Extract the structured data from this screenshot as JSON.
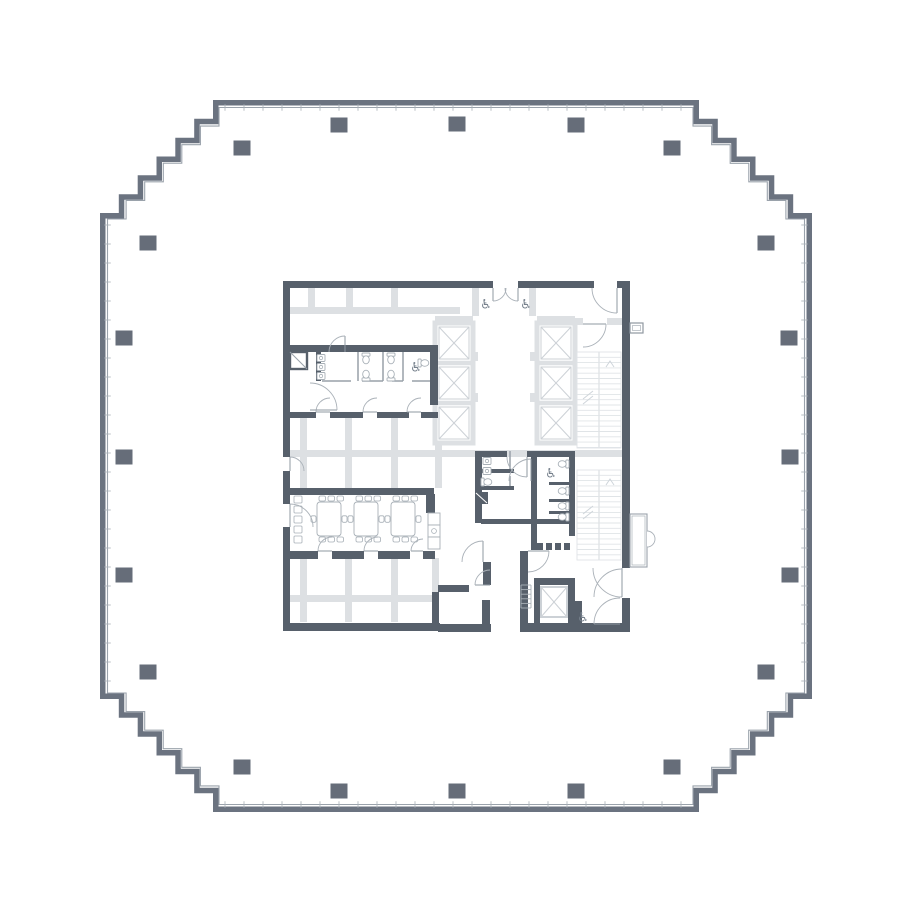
{
  "canvas": {
    "width": 914,
    "height": 914,
    "background": "#ffffff"
  },
  "palette": {
    "outer_wall": "#6b7380",
    "inner_line": "#9aa2ab",
    "mullion_tick": "#a9b0b7",
    "column": "#666d79",
    "wall": "#57606b",
    "light_wall": "#dde0e3",
    "shaft_line": "#ccd1d6",
    "stair_line": "#e0e4e7",
    "stair_mark": "#cfd5da",
    "fixture_line": "#a8b0b7",
    "door_line": "#aab1b8",
    "leaf_line": "#8f98a1",
    "icon": "#76808c",
    "thin_wall": "#98a1a9"
  },
  "outline": {
    "outer": {
      "min": 100,
      "max": 812,
      "flat": 213
    },
    "inner": {
      "min": 107.5,
      "max": 804.5,
      "flat": 219
    },
    "steps": 6,
    "tick_spacing": 19
  },
  "columns": {
    "w": 17,
    "h": 15,
    "centers": [
      [
        339,
        125
      ],
      [
        457,
        124
      ],
      [
        576,
        125
      ],
      [
        242,
        148
      ],
      [
        672,
        148
      ],
      [
        148,
        243
      ],
      [
        766,
        243
      ],
      [
        124,
        338
      ],
      [
        789,
        338
      ],
      [
        124,
        457
      ],
      [
        790,
        457
      ],
      [
        124,
        575
      ],
      [
        790,
        575
      ],
      [
        148,
        672
      ],
      [
        766,
        672
      ],
      [
        242,
        767
      ],
      [
        672,
        767
      ],
      [
        339,
        791
      ],
      [
        457,
        791
      ],
      [
        576,
        791
      ]
    ]
  },
  "core": {
    "light_bars": [
      [
        288,
        307,
        172,
        7
      ],
      [
        308,
        288,
        7,
        19
      ],
      [
        346,
        288,
        7,
        19
      ],
      [
        391,
        288,
        7,
        19
      ],
      [
        300,
        418,
        7,
        70
      ],
      [
        345,
        418,
        7,
        70
      ],
      [
        391,
        418,
        7,
        70
      ],
      [
        435,
        418,
        7,
        70
      ],
      [
        288,
        450,
        340,
        7
      ],
      [
        300,
        558,
        7,
        64
      ],
      [
        345,
        558,
        7,
        64
      ],
      [
        391,
        558,
        7,
        64
      ],
      [
        432,
        558,
        7,
        64
      ],
      [
        288,
        595,
        150,
        7
      ],
      [
        472,
        288,
        7,
        28
      ],
      [
        529,
        288,
        7,
        28
      ],
      [
        435,
        316,
        38,
        7
      ],
      [
        537,
        316,
        38,
        7
      ],
      [
        473,
        352,
        5,
        9
      ],
      [
        473,
        393,
        5,
        9
      ],
      [
        530,
        352,
        5,
        9
      ],
      [
        530,
        393,
        5,
        9
      ],
      [
        575,
        318,
        8,
        7
      ],
      [
        607,
        318,
        16,
        7
      ]
    ],
    "elevator_banks": [
      {
        "x": 435,
        "y": 323,
        "w": 38,
        "h": 120,
        "cells": 3
      },
      {
        "x": 537,
        "y": 323,
        "w": 38,
        "h": 120,
        "cells": 3
      }
    ],
    "service_shaft": {
      "x": 541,
      "y": 587,
      "w": 26,
      "h": 30
    },
    "stairs": [
      {
        "x": 577,
        "y": 352,
        "w": 44,
        "h": 96
      },
      {
        "x": 577,
        "y": 470,
        "w": 44,
        "h": 90
      }
    ],
    "walls": [
      [
        283,
        281,
        210,
        7
      ],
      [
        518,
        281,
        76,
        7
      ],
      [
        617,
        281,
        13,
        7
      ],
      [
        283,
        281,
        7,
        131
      ],
      [
        283,
        418,
        7,
        39
      ],
      [
        283,
        471,
        7,
        33
      ],
      [
        283,
        527,
        7,
        103
      ],
      [
        283,
        412,
        33,
        6
      ],
      [
        330,
        412,
        33,
        6
      ],
      [
        377,
        412,
        32,
        6
      ],
      [
        421,
        412,
        17,
        6
      ],
      [
        283,
        345,
        155,
        7
      ],
      [
        316,
        352,
        5,
        29
      ],
      [
        430,
        352,
        8,
        53
      ],
      [
        288,
        488,
        146,
        7
      ],
      [
        288,
        551,
        30,
        8
      ],
      [
        332,
        551,
        32,
        8
      ],
      [
        378,
        551,
        32,
        8
      ],
      [
        423,
        551,
        12,
        8
      ],
      [
        426,
        494,
        9,
        19
      ],
      [
        432,
        592,
        7,
        38
      ],
      [
        438,
        585,
        31,
        7
      ],
      [
        482,
        600,
        8,
        32
      ],
      [
        483,
        562,
        8,
        23
      ],
      [
        283,
        623,
        157,
        8
      ],
      [
        438,
        624,
        53,
        8
      ],
      [
        520,
        623,
        110,
        9
      ],
      [
        475,
        451,
        32,
        6
      ],
      [
        527,
        451,
        48,
        6
      ],
      [
        475,
        451,
        7,
        41
      ],
      [
        475,
        504,
        7,
        19
      ],
      [
        481,
        519,
        50,
        5
      ],
      [
        531,
        451,
        6,
        74
      ],
      [
        569,
        451,
        6,
        85
      ],
      [
        482,
        469,
        32,
        4
      ],
      [
        482,
        486,
        32,
        4
      ],
      [
        549,
        482,
        20,
        3
      ],
      [
        549,
        499,
        20,
        3
      ],
      [
        549,
        511,
        20,
        3
      ],
      [
        531,
        519,
        44,
        5
      ],
      [
        531,
        519,
        6,
        31
      ],
      [
        520,
        551,
        8,
        72
      ],
      [
        534,
        578,
        41,
        7
      ],
      [
        534,
        585,
        6,
        40
      ],
      [
        568,
        585,
        7,
        40
      ],
      [
        622,
        281,
        8,
        287
      ],
      [
        622,
        598,
        8,
        34
      ],
      [
        575,
        601,
        7,
        31
      ]
    ],
    "thin_walls": [
      [
        358,
        352,
        358,
        381
      ],
      [
        383,
        352,
        383,
        381
      ],
      [
        403,
        352,
        403,
        381
      ],
      [
        322,
        381,
        351,
        381
      ],
      [
        362,
        381,
        383,
        381
      ],
      [
        392,
        381,
        403,
        381
      ],
      [
        412,
        381,
        430,
        381
      ],
      [
        510,
        451,
        510,
        469
      ],
      [
        510,
        476,
        510,
        490
      ]
    ],
    "louvers": {
      "y": 543,
      "x0": 537,
      "n": 4,
      "w": 6,
      "gap": 3,
      "h": 7
    },
    "diag_boxes": [
      {
        "x": 290,
        "y": 352,
        "w": 17,
        "h": 17,
        "filled": false
      },
      {
        "x": 475,
        "y": 492,
        "w": 13,
        "h": 12,
        "filled": true
      }
    ],
    "doors": [
      [
        493,
        288,
        13,
        90,
        0
      ],
      [
        518,
        288,
        13,
        90,
        180
      ],
      [
        617,
        288,
        25,
        90,
        180
      ],
      [
        583,
        324,
        23,
        0,
        90
      ],
      [
        330,
        412,
        14,
        180,
        270
      ],
      [
        377,
        412,
        14,
        180,
        270
      ],
      [
        421,
        412,
        14,
        180,
        270
      ],
      [
        310,
        410,
        27,
        0,
        270
      ],
      [
        290,
        471,
        14,
        270,
        0
      ],
      [
        290,
        527,
        23,
        270,
        0
      ],
      [
        332,
        551,
        14,
        180,
        270
      ],
      [
        378,
        551,
        14,
        180,
        270
      ],
      [
        423,
        551,
        12,
        180,
        270
      ],
      [
        527,
        457,
        20,
        90,
        180
      ],
      [
        531,
        481,
        22,
        270,
        180
      ],
      [
        483,
        562,
        21,
        270,
        180
      ],
      [
        490,
        585,
        15,
        180,
        270
      ],
      [
        622,
        568,
        29,
        90,
        180
      ],
      [
        622,
        597,
        28,
        270,
        180
      ],
      [
        620,
        624,
        26,
        180,
        270
      ],
      [
        528,
        551,
        21,
        0,
        90
      ],
      [
        345,
        352,
        16,
        270,
        180
      ]
    ],
    "vestibule": {
      "x": 630,
      "y": 514,
      "w": 17,
      "h": 53,
      "door_y1": 531,
      "door_y2": 547,
      "bulge": 8
    },
    "cabinet": {
      "x": 630,
      "y": 323,
      "w": 13,
      "h": 10
    },
    "ladder": {
      "x": 521,
      "y": 585,
      "w": 10,
      "dy": 4.6,
      "n": 5
    },
    "toilets": [
      [
        366,
        360,
        0
      ],
      [
        391,
        360,
        0
      ],
      [
        425,
        363,
        270
      ],
      [
        366,
        374,
        180
      ],
      [
        391,
        374,
        180
      ],
      [
        488,
        482,
        270
      ],
      [
        562,
        464,
        90
      ],
      [
        562,
        491,
        90
      ],
      [
        562,
        506,
        90
      ],
      [
        562,
        517,
        90
      ]
    ],
    "sinks": [
      [
        321,
        358
      ],
      [
        321,
        367
      ],
      [
        321,
        376
      ],
      [
        487,
        461
      ],
      [
        487,
        471
      ]
    ],
    "tables": [
      [
        317,
        502,
        24,
        34
      ],
      [
        354,
        502,
        24,
        34
      ],
      [
        391,
        502,
        24,
        34
      ]
    ],
    "stools": [
      [
        294,
        496
      ],
      [
        294,
        506
      ],
      [
        294,
        516
      ],
      [
        294,
        526
      ],
      [
        294,
        536
      ]
    ],
    "kitchen": {
      "x": 428,
      "y": 513,
      "s": 12,
      "n": 3,
      "sink_unit": 1
    },
    "icons": {
      "wheelchair": {
        "glyph": "♿",
        "size": 13,
        "positions": [
          [
            486,
            305
          ],
          [
            526,
            305
          ],
          [
            416,
            368
          ],
          [
            551,
            474
          ],
          [
            583,
            618
          ]
        ]
      }
    }
  }
}
